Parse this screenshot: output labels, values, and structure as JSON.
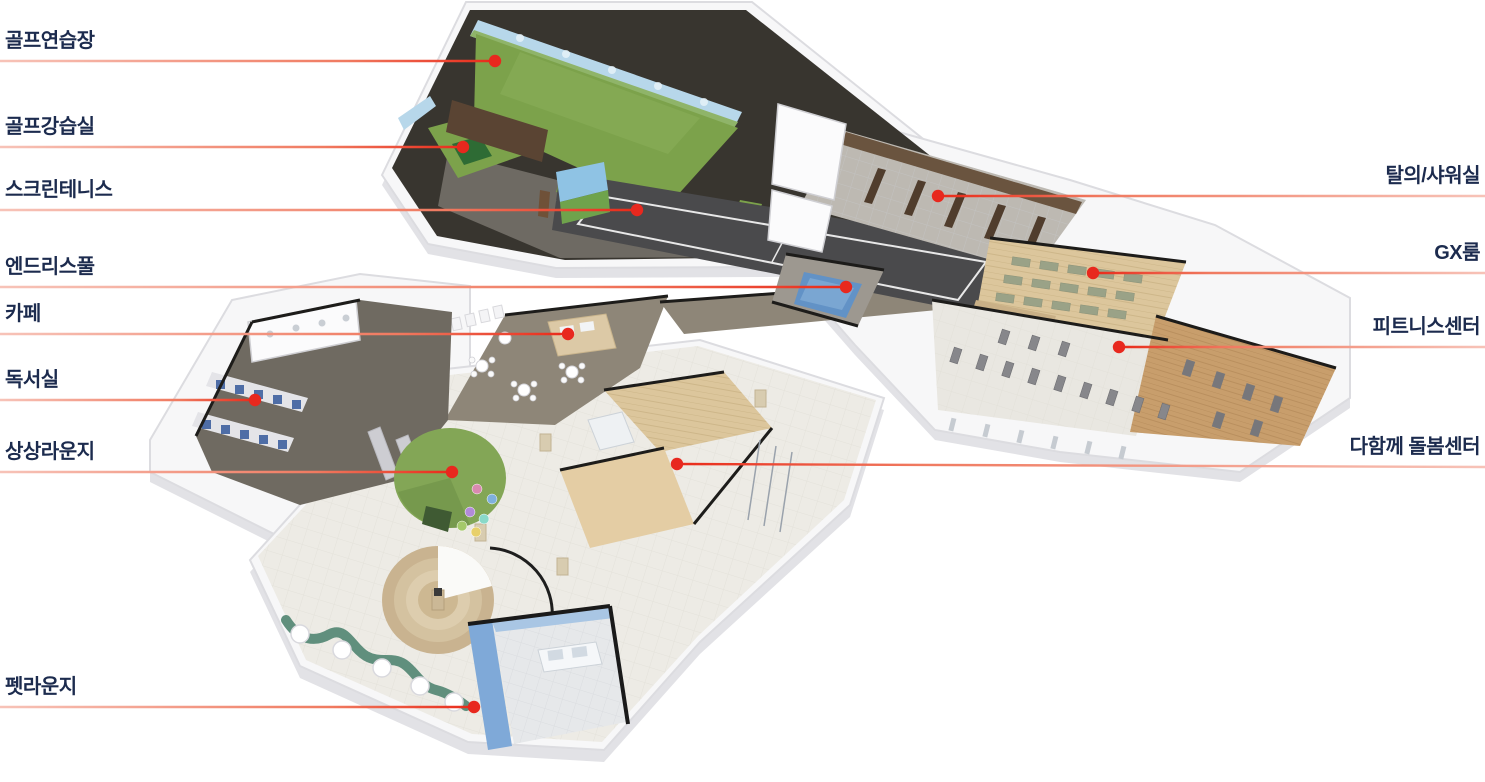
{
  "page": {
    "type": "isometric-floorplan-diagram",
    "background": "#ffffff"
  },
  "colors": {
    "label_text": "#1c2b4e",
    "leader_line_light": "#f7c3b8",
    "leader_line_red": "#e92a19",
    "dot": "#e8281e",
    "turf_green": "#7ca24b",
    "pool_blue": "#6292c6",
    "wood_floor": "#c89e6c",
    "dome_green": "#83a656",
    "wave_bench": "#608f7d",
    "dark_wall": "#38352f"
  },
  "annotations": [
    {
      "key": "golf-practice-range",
      "label": "골프연습장",
      "side": "left",
      "line_y": 61,
      "dot_x": 495,
      "dot_y": 61
    },
    {
      "key": "golf-lesson-room",
      "label": "골프강습실",
      "side": "left",
      "line_y": 147,
      "dot_x": 463,
      "dot_y": 147
    },
    {
      "key": "screen-tennis",
      "label": "스크린테니스",
      "side": "left",
      "line_y": 210,
      "dot_x": 637,
      "dot_y": 210
    },
    {
      "key": "endless-pool",
      "label": "엔드리스풀",
      "side": "left",
      "line_y": 287,
      "dot_x": 846,
      "dot_y": 287
    },
    {
      "key": "cafe",
      "label": "카페",
      "side": "left",
      "line_y": 334,
      "dot_x": 568,
      "dot_y": 334
    },
    {
      "key": "reading-room",
      "label": "독서실",
      "side": "left",
      "line_y": 400,
      "dot_x": 255,
      "dot_y": 400
    },
    {
      "key": "imagination-lounge",
      "label": "상상라운지",
      "side": "left",
      "line_y": 472,
      "dot_x": 452,
      "dot_y": 472
    },
    {
      "key": "pet-lounge",
      "label": "펫라운지",
      "side": "left",
      "line_y": 707,
      "dot_x": 474,
      "dot_y": 707
    },
    {
      "key": "locker-shower-room",
      "label": "탈의/샤워실",
      "side": "right",
      "line_y": 196,
      "dot_x": 938,
      "dot_y": 196
    },
    {
      "key": "gx-room",
      "label": "GX룸",
      "side": "right",
      "line_y": 273,
      "dot_x": 1093,
      "dot_y": 273
    },
    {
      "key": "fitness-center",
      "label": "피트니스센터",
      "side": "right",
      "line_y": 347,
      "dot_x": 1119,
      "dot_y": 347
    },
    {
      "key": "together-care-center",
      "label": "다함께 돌봄센터",
      "side": "right",
      "line_y": 467,
      "dot_x": 677,
      "dot_y": 464
    }
  ]
}
